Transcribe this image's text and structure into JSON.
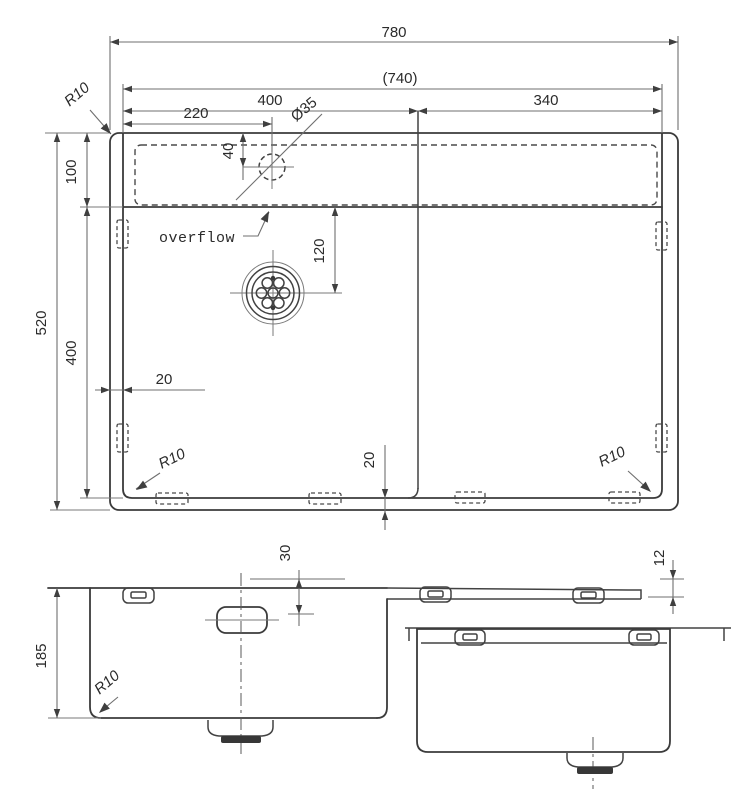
{
  "plan_view": {
    "overall_width": "780",
    "cutout_width": "(740)",
    "left_section_width": "400",
    "right_section_width": "340",
    "tap_hole_offset_x": "220",
    "tap_hole_diameter": "Ø35",
    "tap_hole_offset_y": "40",
    "overall_depth": "520",
    "deck_depth": "100",
    "bowl_depth": "400",
    "drain_center_offset": "120",
    "edge_gap_left": "20",
    "edge_gap_bottom": "20",
    "corner_radius": "R10",
    "overflow_label": "overflow"
  },
  "front_view": {
    "bowl_height": "185",
    "overflow_offset": "30",
    "rim_thickness": "12",
    "corner_radius": "R10"
  }
}
